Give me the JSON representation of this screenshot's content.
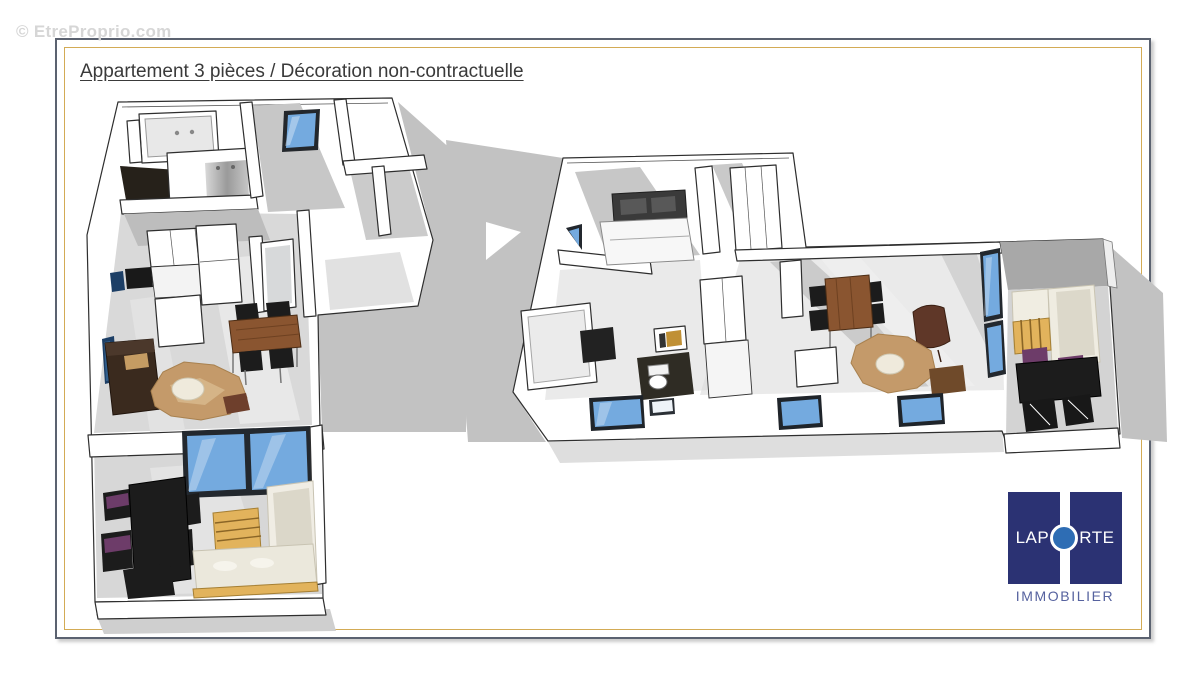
{
  "watermark": {
    "text": "© EtreProprio.com"
  },
  "header": {
    "title": "Appartement 3 pièces / Décoration non-contractuelle"
  },
  "logo": {
    "word_left": "LAP",
    "word_right": "RTE",
    "subtitle": "IMMOBILIER"
  },
  "colors": {
    "frame-border": "#5b6270",
    "frame-gold": "#d3ab55",
    "window-blue": "#74aadf",
    "wood": "#8a5530",
    "rug": "#c49a6a",
    "gold-wood": "#e2b35c",
    "purple": "#6d3c69",
    "logo-navy": "#2b3273",
    "logo-circle": "#2e6db4",
    "logo-text": "#56629f",
    "title-color": "#3a3a3a",
    "watermark-color": "#d6d6d6"
  }
}
